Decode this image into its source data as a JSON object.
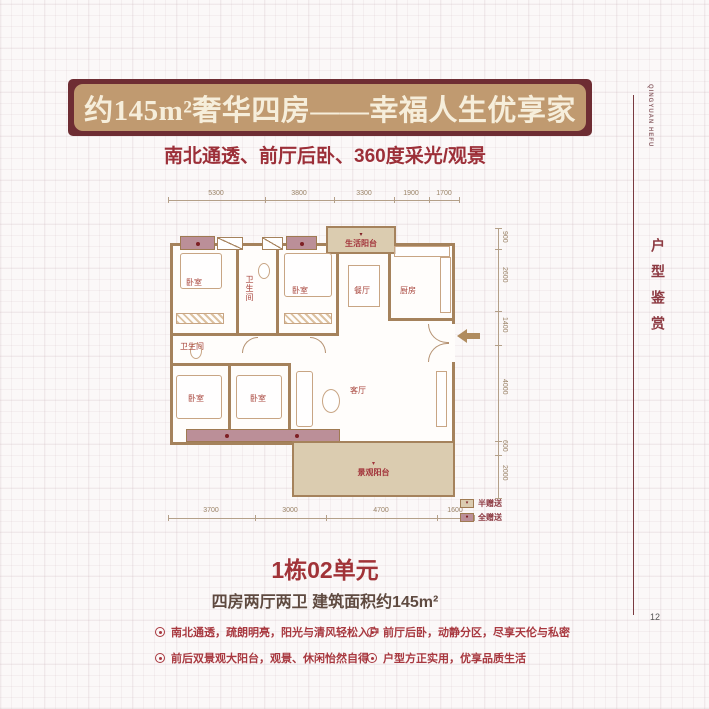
{
  "banner": {
    "title": "约145m²奢华四房——幸福人生优享家"
  },
  "subtitle": "南北通透、前厅后卧、360度采光/观景",
  "sidebar": {
    "brand_en_line1": "QINGYUAN",
    "brand_en_line2": "HEFU",
    "vertical_title": "户型鉴赏",
    "page_number": "12"
  },
  "floorplan": {
    "dims_top": [
      "5300",
      "3800",
      "3300",
      "1900",
      "1700"
    ],
    "dims_bottom": [
      "3700",
      "3000",
      "4700",
      "1600"
    ],
    "dims_right": [
      "900",
      "2600",
      "1400",
      "4000",
      "600",
      "2000"
    ],
    "rooms": [
      {
        "label": "卧室"
      },
      {
        "label": "卫生间"
      },
      {
        "label": "卧室"
      },
      {
        "label": "餐厅"
      },
      {
        "label": "厨房"
      },
      {
        "label": "生活阳台"
      },
      {
        "label": "卫生间"
      },
      {
        "label": "卧室"
      },
      {
        "label": "卧室"
      },
      {
        "label": "客厅"
      },
      {
        "label": "景观阳台"
      }
    ],
    "legend": [
      {
        "mark": "▾",
        "label": "半赠送"
      },
      {
        "mark": "●",
        "label": "全赠送"
      }
    ],
    "colors": {
      "wall": "#a5825c",
      "half_gift": "#dbccb0",
      "full_gift": "#bb8f98"
    }
  },
  "unit": {
    "name": "1栋02单元",
    "spec": "四房两厅两卫 建筑面积约145m²"
  },
  "features": [
    "南北通透，疏朗明亮，阳光与清风轻松入户",
    "前厅后卧，动静分区，尽享天伦与私密",
    "前后双景观大阳台，观景、休闲怡然自得",
    "户型方正实用，优享品质生活"
  ]
}
